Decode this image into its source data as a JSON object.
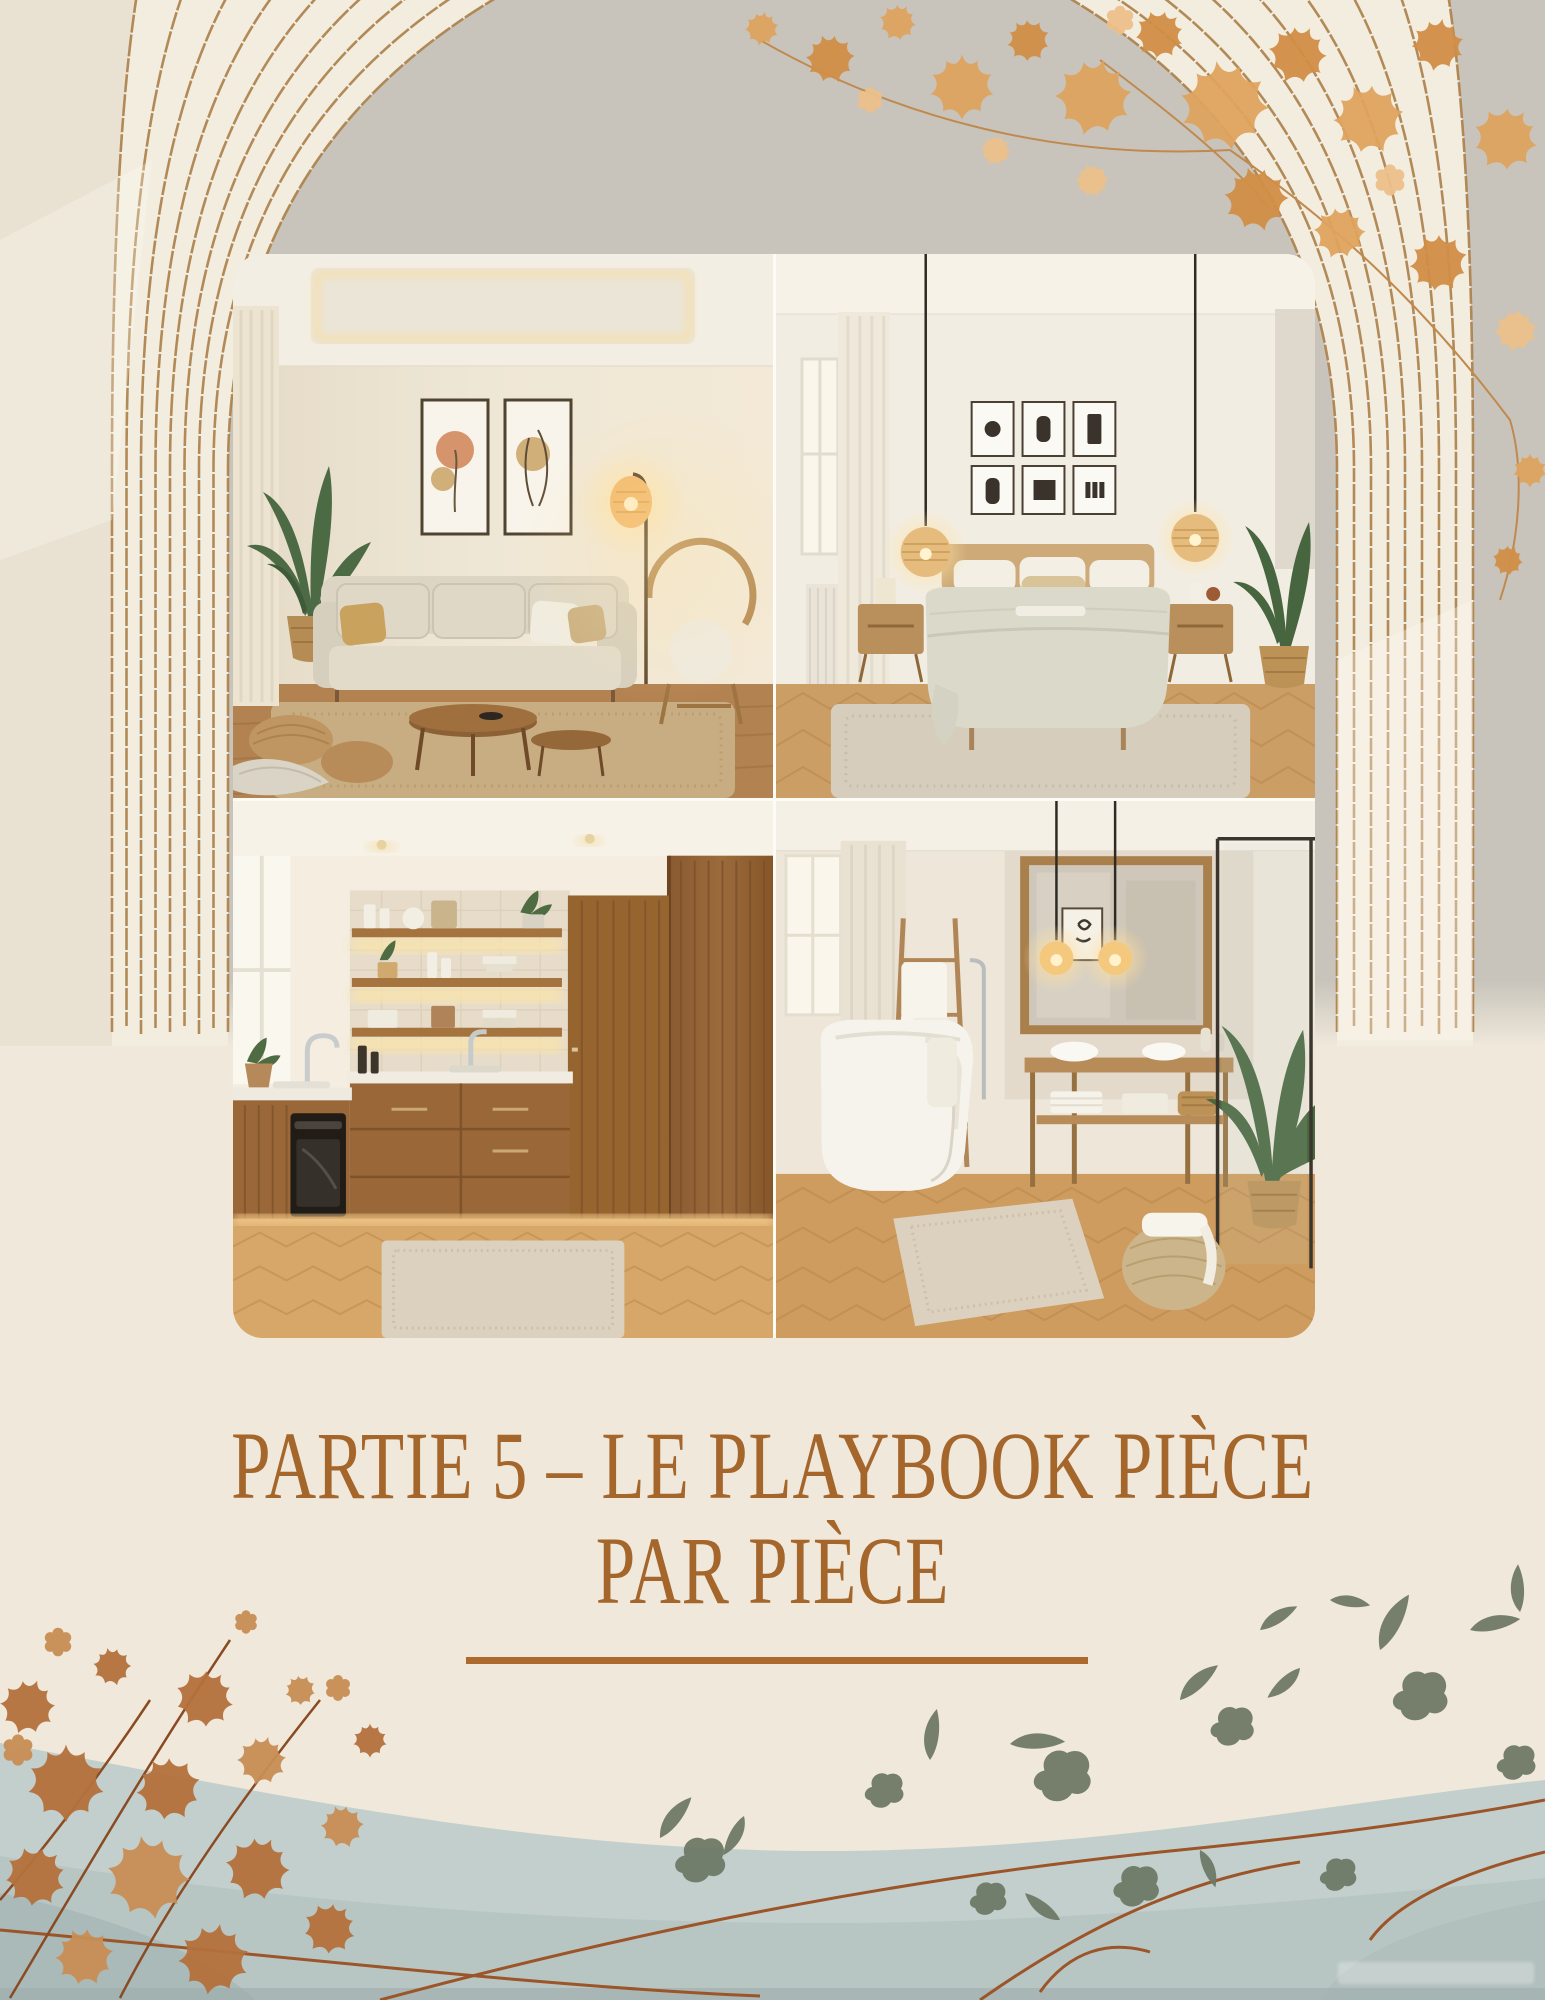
{
  "title": {
    "line1": "PARTIE 5 – LE PLAYBOOK PIÈCE",
    "line2": "PAR PIÈCE",
    "full": "PARTIE 5 – LE PLAYBOOK PIÈCE PAR PIÈCE"
  },
  "collage": {
    "photos": [
      {
        "name": "living-room"
      },
      {
        "name": "bedroom"
      },
      {
        "name": "kitchen"
      },
      {
        "name": "bathroom"
      }
    ]
  },
  "colors": {
    "page_bg": "#EFE8DB",
    "opening_bg": "#C8C4BB",
    "pillar_bg": "#F3EDE0",
    "title_color": "#A5662B",
    "divider_color": "#AC6A2E",
    "arch_line": "#AC8049",
    "foliage_gold": "#DFA45E",
    "foliage_rust": "#B5713C",
    "foliage_green": "#6E7A67",
    "wave": "#C3CFCC",
    "wave_deep": "#A9BAB8",
    "branch": "#9C5429"
  }
}
